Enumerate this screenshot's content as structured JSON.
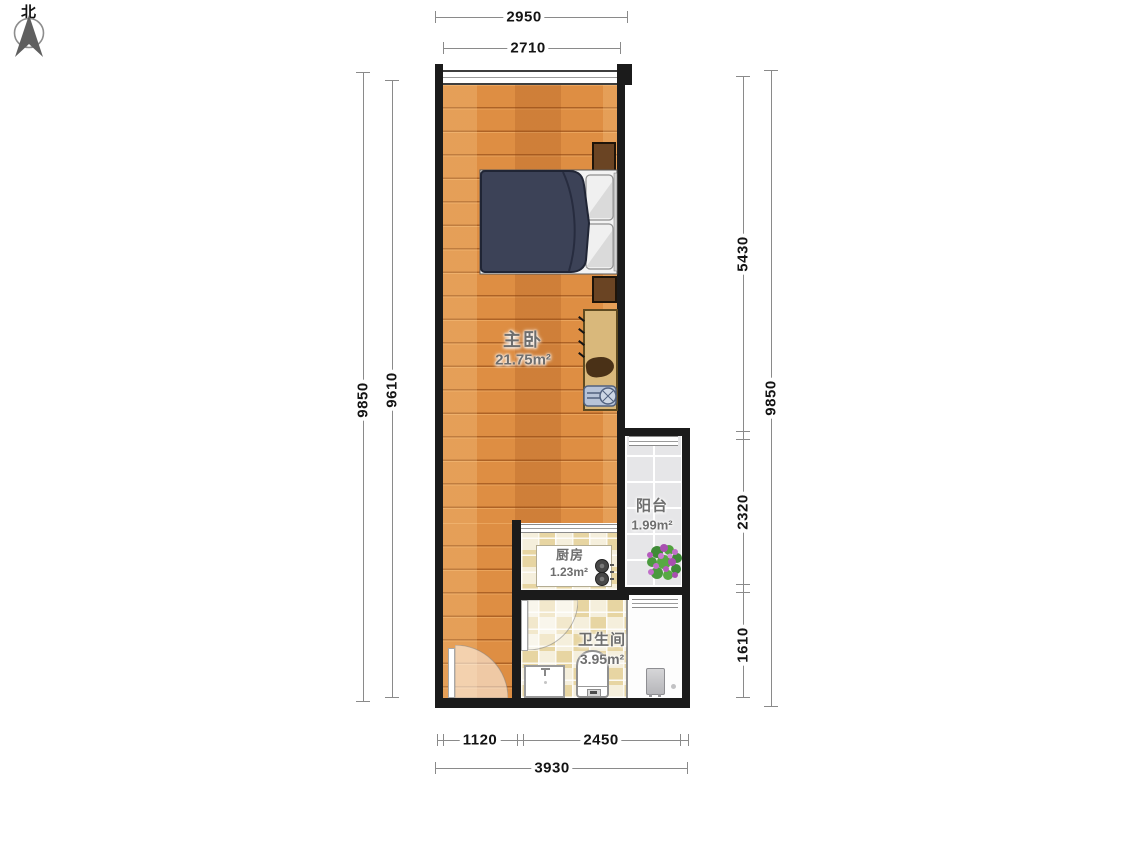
{
  "compass": {
    "label": "北"
  },
  "rooms": {
    "bedroom": {
      "name": "主卧",
      "area": "21.75m²"
    },
    "balcony": {
      "name": "阳台",
      "area": "1.99m²"
    },
    "kitchen": {
      "name": "厨房",
      "area": "1.23m²"
    },
    "bathroom": {
      "name": "卫生间",
      "area": "3.95m²"
    }
  },
  "dimensions_mm": {
    "top_outer": "2950",
    "top_inner": "2710",
    "left_outer": "9850",
    "left_inner": "9610",
    "right_upper": "5430",
    "right_middle": "2320",
    "right_lower": "1610",
    "right_outer": "9850",
    "bottom_left": "1120",
    "bottom_right": "2450",
    "bottom_outer": "3930"
  },
  "colors": {
    "wall": "#1b1b1b",
    "wood_floor": "#de8e43",
    "tile_beige": "#f0e6c8",
    "tile_gray": "#e6e6e8",
    "bed_duvet": "#3c4257",
    "furniture_brown": "#6a4423",
    "desk_tan": "#d9b87b",
    "dimension_line": "#8a8a8a",
    "room_label_text": "#6e6e6e"
  }
}
